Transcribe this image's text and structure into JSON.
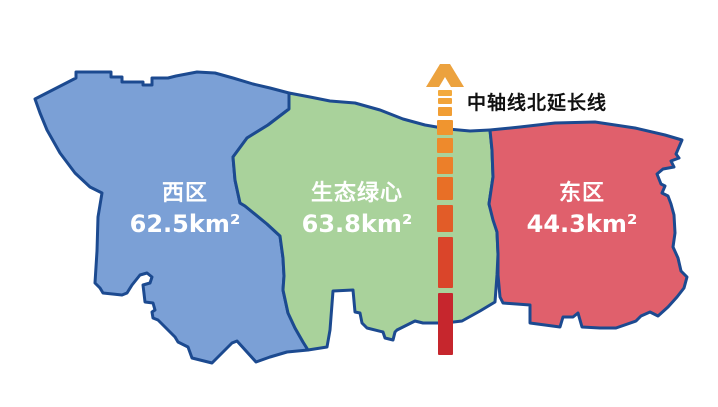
{
  "map": {
    "outline_color": "#1c4a90",
    "background_color": "#ffffff"
  },
  "regions": {
    "west": {
      "name": "西区",
      "area": "62.5km²",
      "fill_color": "#7ba0d6",
      "label_color": "#ffffff"
    },
    "green_heart": {
      "name": "生态绿心",
      "area": "63.8km²",
      "fill_color": "#a9d29b",
      "label_color": "#ffffff"
    },
    "east": {
      "name": "东区",
      "area": "44.3km²",
      "fill_color": "#e0606c",
      "label_color": "#ffffff"
    }
  },
  "axis": {
    "label": "中轴线北延长线",
    "label_color": "#111111",
    "arrow_color": "#eca23e",
    "dashes": [
      {
        "x": 438,
        "y": 90,
        "w": 14,
        "h": 6,
        "color": "#f3aa3d"
      },
      {
        "x": 438,
        "y": 98,
        "w": 14,
        "h": 6,
        "color": "#f2a439"
      },
      {
        "x": 438,
        "y": 107,
        "w": 14,
        "h": 9,
        "color": "#f19e34"
      },
      {
        "x": 437,
        "y": 120,
        "w": 16,
        "h": 15,
        "color": "#f0952f"
      },
      {
        "x": 437,
        "y": 138,
        "w": 16,
        "h": 15,
        "color": "#ee8a2c"
      },
      {
        "x": 437,
        "y": 157,
        "w": 16,
        "h": 17,
        "color": "#ec7f29"
      },
      {
        "x": 437,
        "y": 177,
        "w": 16,
        "h": 23,
        "color": "#e86f26"
      },
      {
        "x": 437,
        "y": 205,
        "w": 16,
        "h": 27,
        "color": "#e25c28"
      },
      {
        "x": 438,
        "y": 237,
        "w": 15,
        "h": 51,
        "color": "#da452a"
      },
      {
        "x": 438,
        "y": 293,
        "w": 15,
        "h": 62,
        "color": "#c6262d"
      }
    ]
  }
}
